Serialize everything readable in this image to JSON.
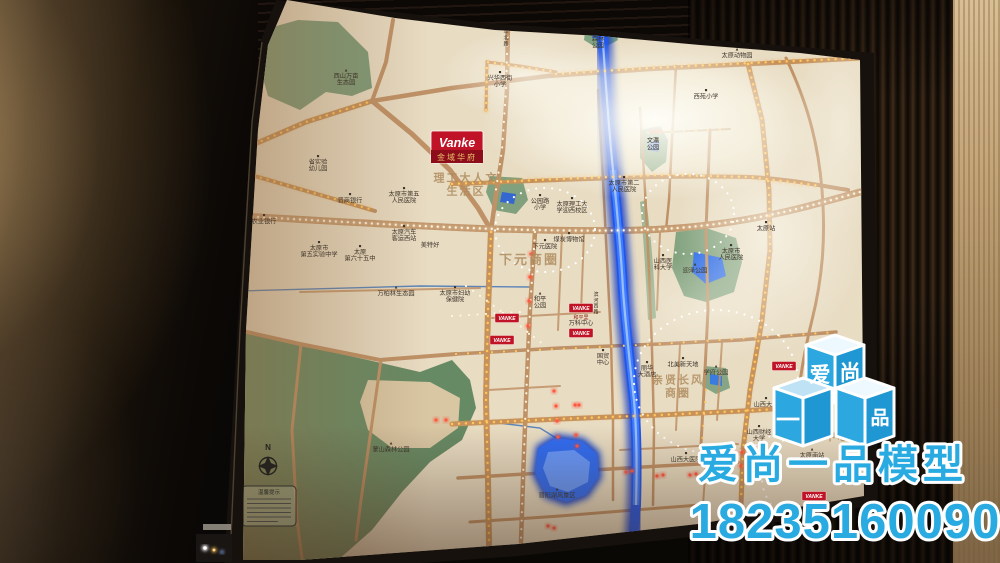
{
  "scene": {
    "compass_label": "N",
    "legend_title": "温馨提示"
  },
  "map": {
    "project_logo": {
      "brand": "Vanke",
      "name": "金域华府"
    },
    "vanke_label": "VANKE",
    "vanke_markers": [
      {
        "x": 507,
        "y": 318
      },
      {
        "x": 502,
        "y": 340
      },
      {
        "x": 581,
        "y": 308,
        "sub": "和平里"
      },
      {
        "x": 581,
        "y": 333
      },
      {
        "x": 784,
        "y": 366
      },
      {
        "x": 814,
        "y": 496
      }
    ],
    "district_labels": [
      {
        "x": 466,
        "y": 188,
        "size": 11,
        "lines": [
          "理工大人文",
          "生活区"
        ]
      },
      {
        "x": 529,
        "y": 264,
        "size": 13,
        "lines": [
          "下元商圈"
        ]
      },
      {
        "x": 678,
        "y": 390,
        "size": 11,
        "lines": [
          "亲贤长风",
          "商圈"
        ]
      },
      {
        "x": 818,
        "y": 440,
        "size": 11,
        "lines": [
          "太原新中心"
        ]
      }
    ],
    "labels": [
      {
        "x": 346,
        "y": 78,
        "m": "▲",
        "lines": [
          "西山万亩",
          "生态园"
        ]
      },
      {
        "x": 500,
        "y": 80,
        "m": "■",
        "lines": [
          "兴华西街",
          "小学"
        ]
      },
      {
        "x": 706,
        "y": 95,
        "m": "■",
        "lines": [
          "西苑小学"
        ]
      },
      {
        "x": 598,
        "y": 41,
        "m": "▲",
        "lines": [
          "森林",
          "公园"
        ]
      },
      {
        "x": 737,
        "y": 54,
        "m": "▲",
        "lines": [
          "太原动物园"
        ]
      },
      {
        "x": 653,
        "y": 146,
        "lines": [
          "文瀛",
          "公园"
        ]
      },
      {
        "x": 318,
        "y": 164,
        "m": "■",
        "lines": [
          "省实验",
          "幼儿园"
        ]
      },
      {
        "x": 350,
        "y": 199,
        "m": "■",
        "lines": [
          "晋商银行"
        ]
      },
      {
        "x": 264,
        "y": 220,
        "m": "■",
        "lines": [
          "农业银行"
        ]
      },
      {
        "x": 404,
        "y": 196,
        "m": "■",
        "lines": [
          "太原市第五",
          "人民医院"
        ]
      },
      {
        "x": 404,
        "y": 234,
        "m": "■",
        "lines": [
          "太原汽车",
          "客运西站"
        ]
      },
      {
        "x": 430,
        "y": 247,
        "lines": [
          "美特好"
        ]
      },
      {
        "x": 319,
        "y": 250,
        "m": "■",
        "lines": [
          "太原市",
          "第五实验中学"
        ]
      },
      {
        "x": 360,
        "y": 254,
        "m": "■",
        "lines": [
          "太原",
          "第六十五中"
        ]
      },
      {
        "x": 396,
        "y": 292,
        "m": "▲",
        "lines": [
          "万柏林生态园"
        ]
      },
      {
        "x": 455,
        "y": 295,
        "m": "■",
        "lines": [
          "太原市妇幼",
          "保健院"
        ]
      },
      {
        "x": 569,
        "y": 238,
        "m": "■",
        "lines": [
          "煤炭博物馆"
        ]
      },
      {
        "x": 545,
        "y": 245,
        "m": "■",
        "lines": [
          "下元医院"
        ]
      },
      {
        "x": 540,
        "y": 203,
        "m": "■",
        "lines": [
          "公园路",
          "小学"
        ]
      },
      {
        "x": 572,
        "y": 206,
        "m": "■",
        "lines": [
          "太原理工大",
          "学迎西校区"
        ]
      },
      {
        "x": 624,
        "y": 185,
        "m": "■",
        "lines": [
          "太原市第二",
          "人民医院"
        ]
      },
      {
        "x": 695,
        "y": 269,
        "m": "▲",
        "lines": [
          "迎泽公园"
        ]
      },
      {
        "x": 663,
        "y": 263,
        "m": "■",
        "lines": [
          "山西医",
          "科大学"
        ]
      },
      {
        "x": 766,
        "y": 227,
        "m": "■",
        "lines": [
          "太原站"
        ]
      },
      {
        "x": 731,
        "y": 253,
        "m": "■",
        "lines": [
          "太原市",
          "人民医院"
        ]
      },
      {
        "x": 540,
        "y": 301,
        "m": "▲",
        "lines": [
          "和平",
          "公园"
        ]
      },
      {
        "x": 581,
        "y": 325,
        "lines": [
          "万科中心"
        ]
      },
      {
        "x": 603,
        "y": 358,
        "m": "■",
        "lines": [
          "国贸",
          "中心"
        ]
      },
      {
        "x": 647,
        "y": 370,
        "m": "■",
        "lines": [
          "丽华",
          "大酒店"
        ]
      },
      {
        "x": 683,
        "y": 363,
        "m": "■",
        "lines": [
          "北美新天地"
        ]
      },
      {
        "x": 716,
        "y": 371,
        "m": "▲",
        "lines": [
          "学府公园"
        ]
      },
      {
        "x": 766,
        "y": 403,
        "m": "■",
        "lines": [
          "山西大学"
        ]
      },
      {
        "x": 759,
        "y": 434,
        "m": "■",
        "lines": [
          "山西财经",
          "大学"
        ]
      },
      {
        "x": 686,
        "y": 458,
        "m": "■",
        "lines": [
          "山西大医院"
        ]
      },
      {
        "x": 557,
        "y": 494,
        "m": "▲",
        "lines": [
          "晋阳湖风景区"
        ]
      },
      {
        "x": 391,
        "y": 448,
        "m": "▲",
        "lines": [
          "蒙山森林公园"
        ]
      },
      {
        "x": 812,
        "y": 454,
        "m": "▲",
        "lines": [
          "太原南站"
        ]
      },
      {
        "x": 506,
        "y": 28,
        "stack": true,
        "lines": [
          "和平北路"
        ]
      },
      {
        "x": 596,
        "y": 296,
        "stack": true,
        "lines": [
          "滨河西路"
        ]
      }
    ]
  },
  "watermark": {
    "brand": "爱尚一品模型",
    "phone": "18235160090",
    "cube_chars": [
      "爱",
      "尚",
      "一",
      "品"
    ],
    "color": "#29abe2"
  }
}
